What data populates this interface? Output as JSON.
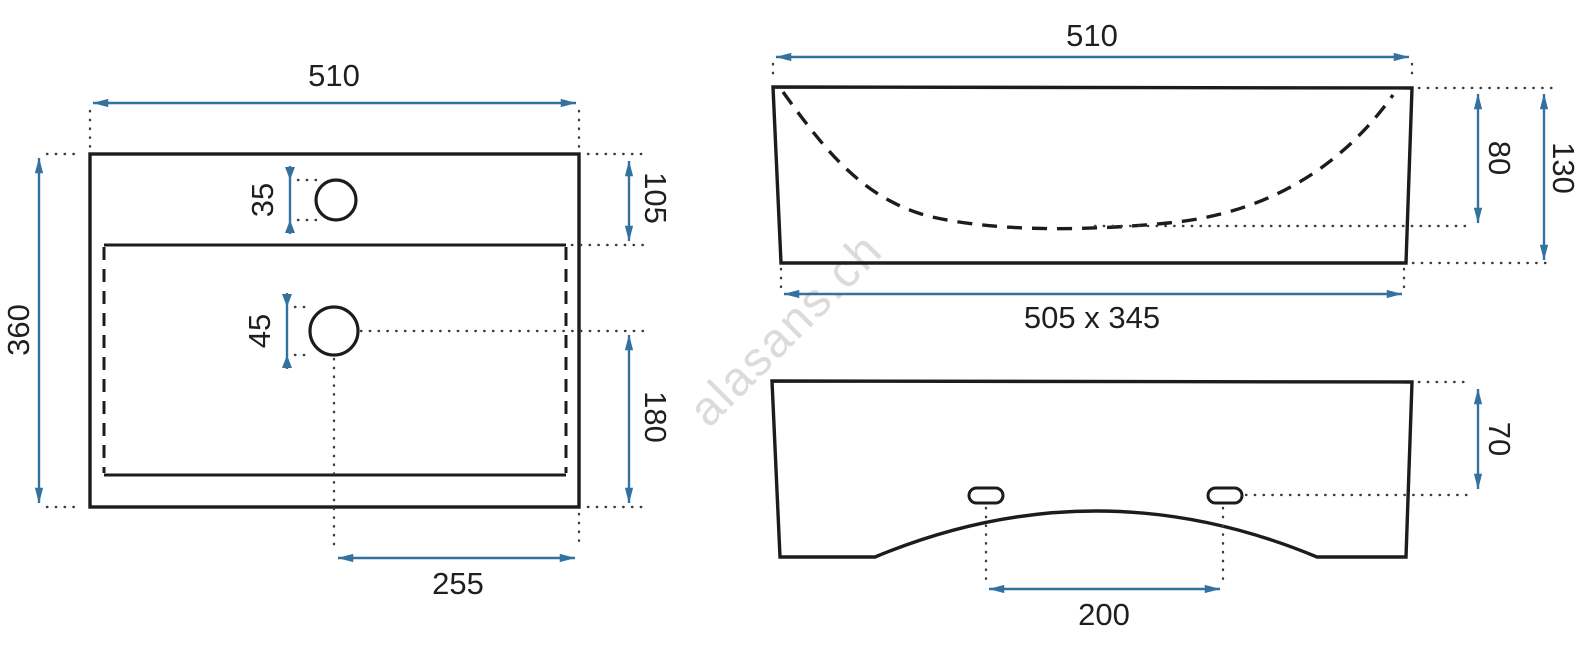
{
  "watermark": {
    "text": "alasans.ch"
  },
  "colors": {
    "dimension_arrow": "#33719f",
    "outline": "#1c1c1c",
    "dotted_extension": "#3b3b3b",
    "watermark": "#c4c4c4"
  },
  "views": {
    "top_view": {
      "width": "510",
      "depth": "360",
      "tap_hole_diameter": "35",
      "drain_hole_diameter": "45",
      "rim_offset_right": "105",
      "drain_to_front_edge": "180",
      "drain_from_right_edge": "255"
    },
    "front_view": {
      "width": "510",
      "basin_depth": "80",
      "total_height": "130",
      "basin_dimensions": "505 x 345"
    },
    "back_view": {
      "mount_hole_offset": "70",
      "mount_hole_spacing": "200"
    }
  }
}
